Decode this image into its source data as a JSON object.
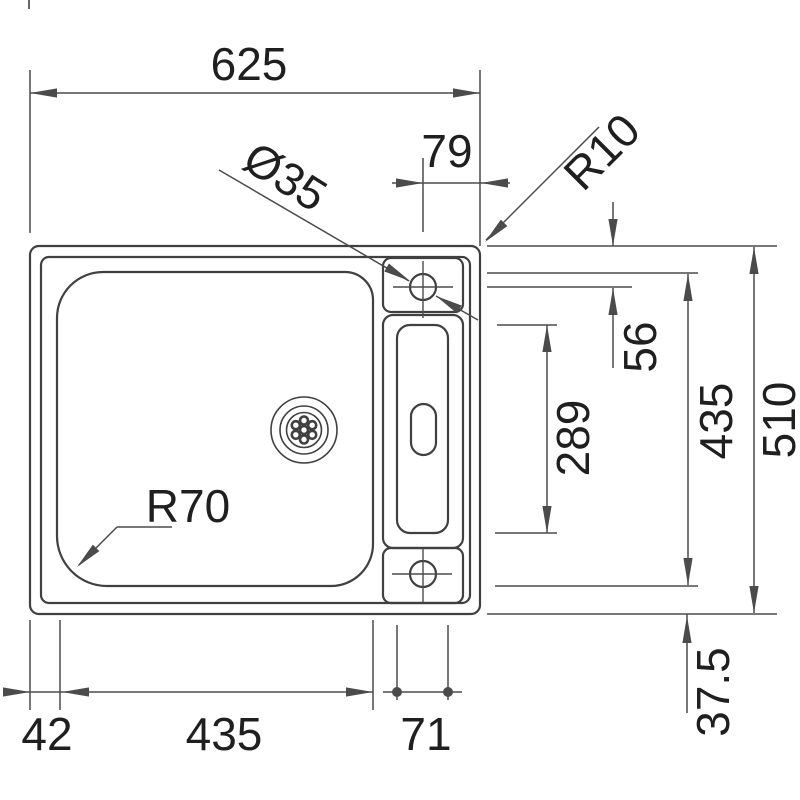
{
  "drawing": {
    "kind": "sink-top-view-dimension-drawing"
  },
  "labels": {
    "overall_width": "625",
    "tap_offset": "79",
    "tap_diameter": "Ø35",
    "rim_radius": "R10",
    "tap_inset": "56",
    "recess_length": "289",
    "bowl_length": "435",
    "overall_depth": "510",
    "edge_margin": "37.5",
    "bowl_radius": "R70",
    "left_margin": "42",
    "bowl_width": "435",
    "recess_width": "71"
  },
  "colors": {
    "ink": "#404040",
    "dimline": "#4b4b4b",
    "text": "#1f1f1f",
    "background": "#ffffff"
  }
}
